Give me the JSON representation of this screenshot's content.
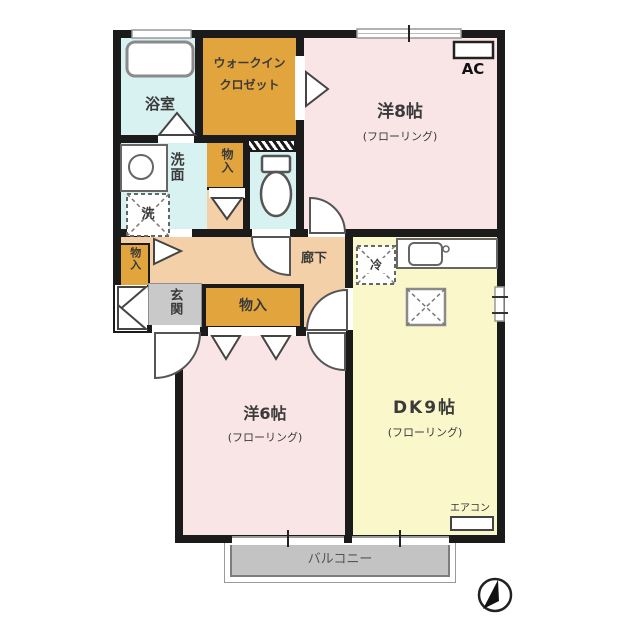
{
  "floor_plan": {
    "rooms": {
      "bathroom": {
        "label": "浴室"
      },
      "walk_in_closet": {
        "line1": "ウォークイン",
        "line2": "クロゼット"
      },
      "western_room_8": {
        "label": "洋8帖",
        "floor": "(フローリング)",
        "ac": "AC"
      },
      "washroom": {
        "label": "洗面",
        "washer": "洗"
      },
      "storage_upper": {
        "label": "物入"
      },
      "storage_left": {
        "label": "物入"
      },
      "storage_wide": {
        "label": "物入"
      },
      "entrance": {
        "label": "玄関"
      },
      "hallway": {
        "label": "廊下"
      },
      "dining_kitchen": {
        "label": "DK9帖",
        "floor": "(フローリング)",
        "refrigerator": "冷",
        "aircon": "エアコン"
      },
      "western_room_6": {
        "label": "洋6帖",
        "floor": "(フローリング)"
      },
      "balcony": {
        "label": "バルコニー"
      }
    },
    "colors": {
      "wall": "#1b1b1b",
      "western_room_pink": "#f9e5e5",
      "dining_kitchen_yellow": "#faf7cb",
      "closet_orange": "#e2a43c",
      "water_area_cyan": "#d8f1f1",
      "hallway_peach": "#f3d0a7",
      "entrance_gray": "#c9c9c9",
      "balcony_gray": "#c3c3c3"
    }
  }
}
